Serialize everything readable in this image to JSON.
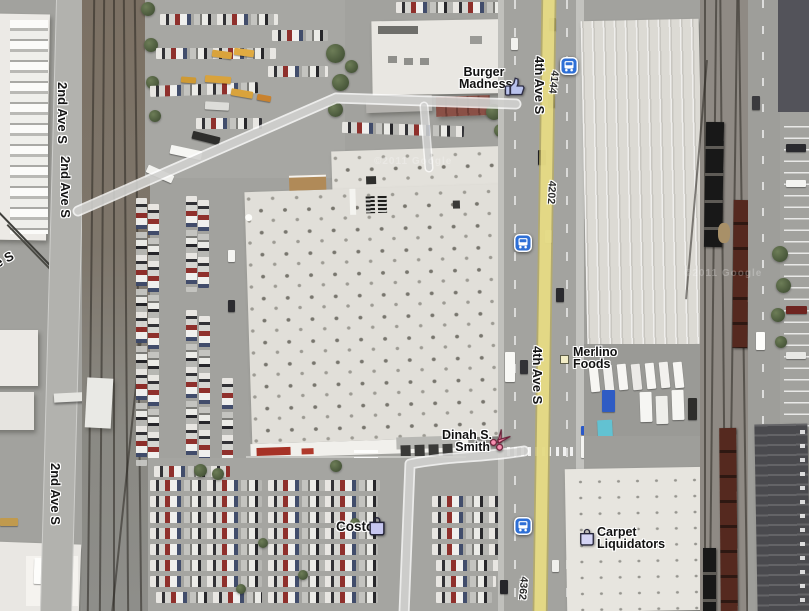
{
  "map": {
    "view_type": "satellite",
    "watermark": "©2011 Google",
    "street_labels": [
      {
        "text": "2nd Ave S"
      },
      {
        "text": "2nd Ave S"
      },
      {
        "text": "2nd Ave S"
      },
      {
        "text": "2nd Ave S"
      },
      {
        "text": "4th Ave S"
      },
      {
        "text": "4th Ave S"
      }
    ],
    "address_labels": [
      {
        "text": "4144"
      },
      {
        "text": "4202"
      },
      {
        "text": "4362"
      }
    ],
    "businesses": [
      {
        "name": "Burger Madness",
        "lines": [
          "Burger",
          "Madness"
        ],
        "icon": "thumbs-up-icon"
      },
      {
        "name": "Merlino Foods",
        "lines": [
          "Merlino",
          "Foods"
        ],
        "icon": "square-marker-icon"
      },
      {
        "name": "Dinah S. Smith",
        "lines": [
          "Dinah S.",
          "Smith"
        ],
        "icon": "scissors-icon"
      },
      {
        "name": "Costco",
        "lines": [
          "Costco"
        ],
        "icon": "shopping-bag-icon"
      },
      {
        "name": "Carpet Liquidators",
        "lines": [
          "Carpet",
          "Liquidators"
        ],
        "icon": "shopping-bag-icon"
      }
    ],
    "transit_stops": [
      {
        "type": "bus stop"
      },
      {
        "type": "bus stop"
      },
      {
        "type": "bus stop"
      }
    ],
    "colors": {
      "bus_icon_blue": "#2e6fd6",
      "road_overlay_yellow": "#ebe189",
      "label_text": "#1a1a1a",
      "label_halo": "#ffffff"
    }
  }
}
